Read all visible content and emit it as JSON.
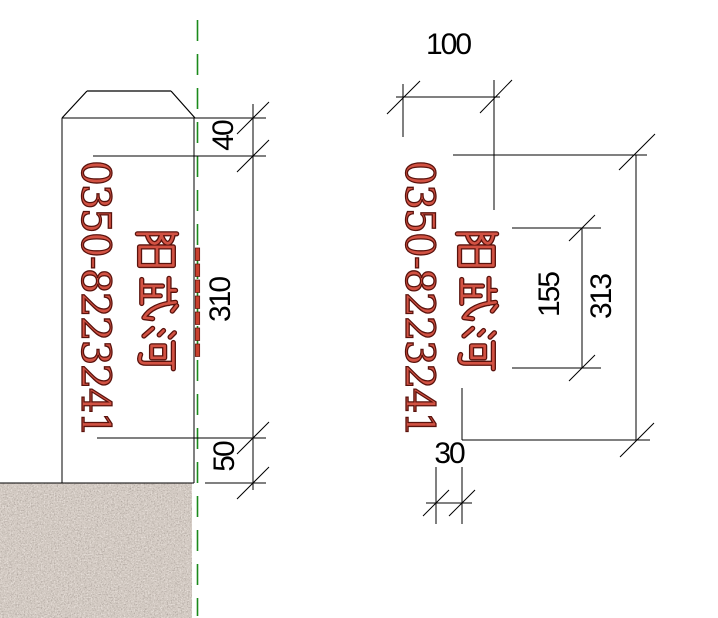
{
  "texts": {
    "phone_number": "0350-8223241",
    "river_name": "阳武河",
    "river_chars": [
      "阳",
      "武",
      "河"
    ]
  },
  "views": {
    "elevation": {
      "dim_top_offset": "40",
      "dim_text_height": "310",
      "dim_bottom_offset": "50"
    },
    "side": {
      "dim_width": "100",
      "dim_total_text_height": "313",
      "dim_river_text_height": "155",
      "dim_text_gap": "30"
    }
  },
  "colors": {
    "red_text_fill": "#d25243",
    "red_text_outline": "#5a120c",
    "centerline_green": "#1b8a1b",
    "line_black": "#000000",
    "granite_base": "#cfc5b8",
    "background": "#ffffff"
  }
}
